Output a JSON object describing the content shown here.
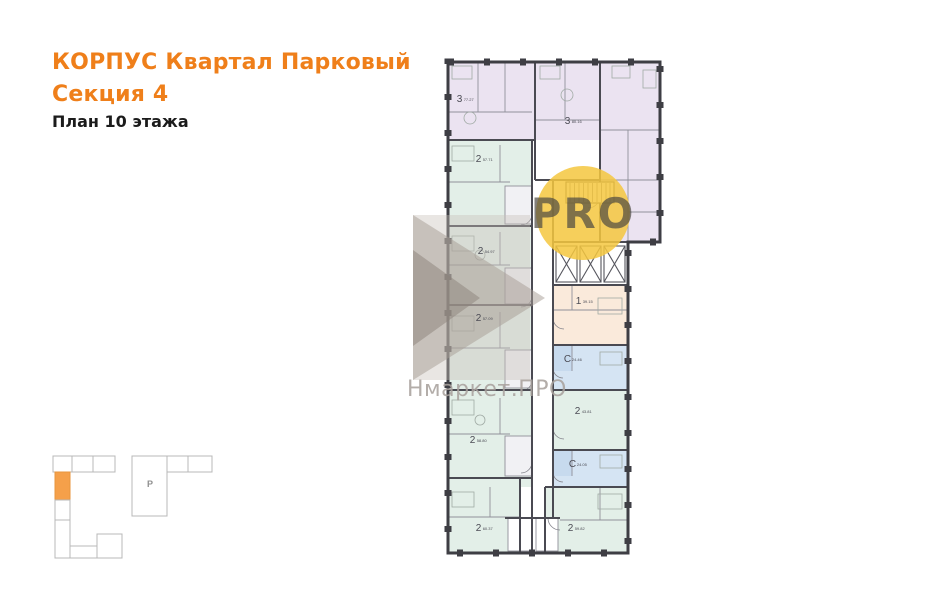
{
  "header": {
    "title_line1": "КОРПУС Квартал Парковый",
    "title_line2": "Секция 4",
    "subtitle": "План 10 этажа"
  },
  "watermarks": {
    "pro_badge_text": "PRO",
    "brand_text": "Нмаркет.ПРО"
  },
  "key_plan": {
    "parking_label": "Р"
  },
  "plan": {
    "floor_label": "10",
    "apartments": [
      {
        "type": "3",
        "area": "77.27",
        "x": 470,
        "y": 100
      },
      {
        "type": "3",
        "area": "80.16",
        "x": 578,
        "y": 122
      },
      {
        "type": "2",
        "area": "57.71",
        "x": 489,
        "y": 160
      },
      {
        "type": "2",
        "area": "54.97",
        "x": 491,
        "y": 252
      },
      {
        "type": "2",
        "area": "57.09",
        "x": 489,
        "y": 319
      },
      {
        "type": "2",
        "area": "58.80",
        "x": 483,
        "y": 441
      },
      {
        "type": "2",
        "area": "60.37",
        "x": 489,
        "y": 529
      },
      {
        "type": "1",
        "area": "39.15",
        "x": 589,
        "y": 302
      },
      {
        "type": "С",
        "area": "24.46",
        "x": 578,
        "y": 360
      },
      {
        "type": "2",
        "area": "43.81",
        "x": 588,
        "y": 412
      },
      {
        "type": "С",
        "area": "24.05",
        "x": 583,
        "y": 465
      },
      {
        "type": "2",
        "area": "59.82",
        "x": 581,
        "y": 529
      }
    ]
  },
  "colors": {
    "accent_orange": "#ef7f1a",
    "apt_purple": "#ebe3f1",
    "apt_green": "#e3efe8",
    "apt_blue": "#d5e4f3",
    "apt_blue_dark": "#c7daee",
    "apt_orange": "#faeadb",
    "wall_dark": "#3e3e44",
    "wall_inner": "#4a4a52",
    "wall_light": "#90909a",
    "watermark_yellow": "#f5c73e",
    "logo_gray_light": "#c8c1ba",
    "logo_gray_mid": "#a59b94",
    "logo_gray_dark": "#8c8279",
    "keyplan_orange": "#f5a04a",
    "keyplan_stroke": "#b8b8b8"
  }
}
